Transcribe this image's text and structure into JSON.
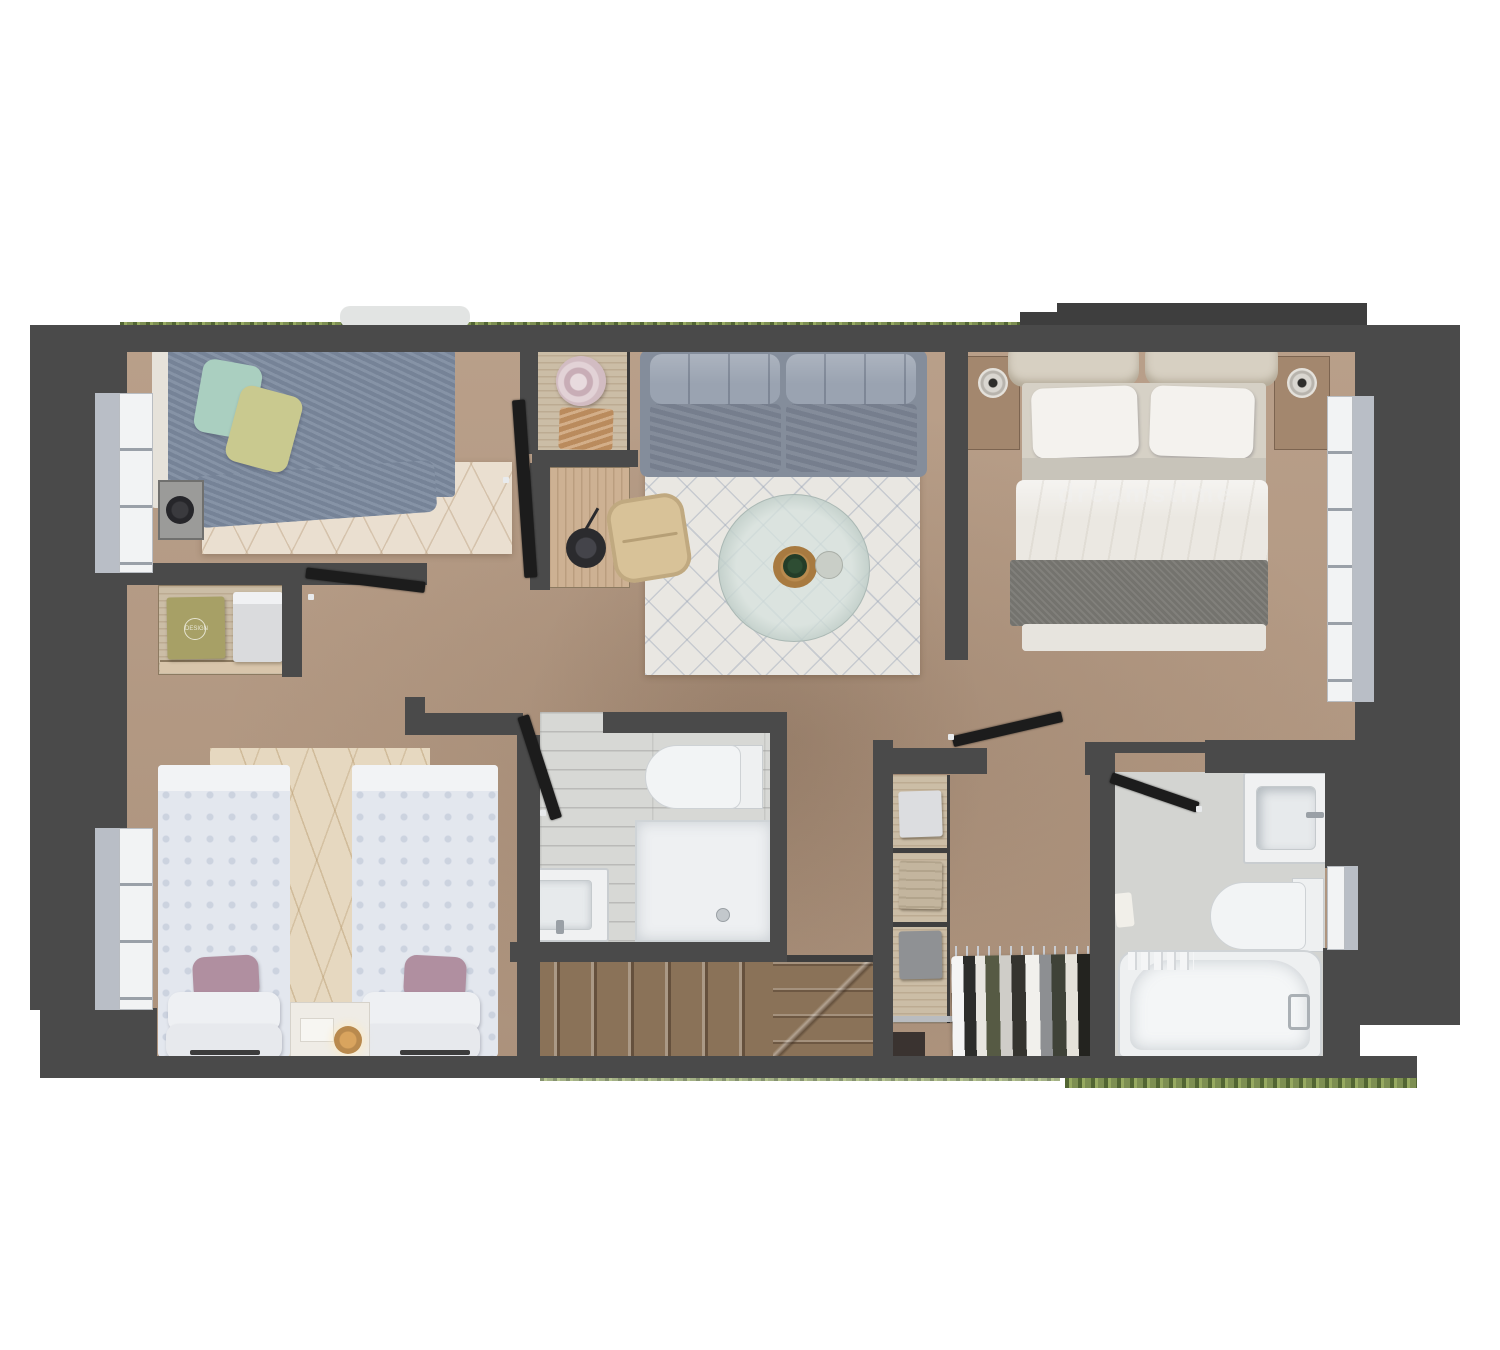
{
  "meta": {
    "title": "upper-floor-plan-3d-top-view"
  },
  "watermark": {
    "text": "dreamstime"
  },
  "labels": {
    "shirt_print": "DESIGN"
  },
  "palette": {
    "wall": "#4a4a4a",
    "wallDark": "#3e3e3e",
    "doorLeaf": "#1c1c1c",
    "floorTan": "#b59a83",
    "bathFloor": "#d7d8d5",
    "bathFloor2": "#d3d4d1",
    "fixtureWhite": "#f0f1f2",
    "fixtureBorder": "#c9cdd0",
    "rugCream": "#eadfd0",
    "rugWhite": "#e9e7e2",
    "rugBeige": "#e6d8c0",
    "stairs": "#8a7258",
    "hedge": "#7d8f52",
    "glass": "#b9bec6",
    "frameWhite": "#f2f3f4",
    "wood": "#cdb193",
    "woodLight": "#cbbda6",
    "sofaBase": "#848d9b",
    "sofaBack": "#9aa3b1",
    "sofaSeat": "#7d8695",
    "bedBlue": "#7d8b9f",
    "pillowMint": "#aacfc0",
    "pillowYellow": "#c9c98f",
    "headboardBeige": "#d7d0c2",
    "mattressBeige": "#d6d1c6",
    "duvetWhite": "#ebe8e2",
    "bedBandGray": "#7a7974",
    "twinDuvet": "#e3e7ee",
    "pillowMauve": "#b08fa0",
    "chairTan": "#d8c298",
    "lampDark": "#2b2b2e",
    "hatPink": "#d8c3c9",
    "clothTan": "#c89a6b",
    "shirtOlive": "#a7a066",
    "shirtWhite": "#dadbdd",
    "railGray": "#b9bcc0"
  },
  "rooms": [
    {
      "id": "bedroom-1",
      "items": [
        "double-bed-blue",
        "mint-pillow",
        "yellow-pillow",
        "nightstand-lamp",
        "cream-rug",
        "window"
      ]
    },
    {
      "id": "living-area",
      "items": [
        "sofa",
        "diamond-rug",
        "round-glass-coffee-table",
        "desk",
        "desk-chair",
        "desk-lamp",
        "cabinet-with-hat"
      ]
    },
    {
      "id": "master-bedroom",
      "items": [
        "double-bed-white",
        "two-pillows",
        "gray-runner-blanket",
        "nightstand-left",
        "nightstand-right",
        "window"
      ]
    },
    {
      "id": "bedroom-2",
      "items": [
        "twin-bed-left",
        "twin-bed-right",
        "mauve-pillows",
        "shared-nightstand",
        "beige-rug",
        "dresser-with-shirts",
        "window"
      ]
    },
    {
      "id": "bathroom-1",
      "items": [
        "toilet",
        "shower-tray",
        "sink-vanity",
        "door"
      ]
    },
    {
      "id": "stairs",
      "items": [
        "straight-flight",
        "winder-steps"
      ]
    },
    {
      "id": "walk-in-closet",
      "items": [
        "shelving-folded-clothes",
        "hanging-rail",
        "clothes-on-hangers"
      ]
    },
    {
      "id": "bathroom-2",
      "items": [
        "bathtub",
        "toilet",
        "sink-vanity",
        "window",
        "door"
      ]
    }
  ]
}
